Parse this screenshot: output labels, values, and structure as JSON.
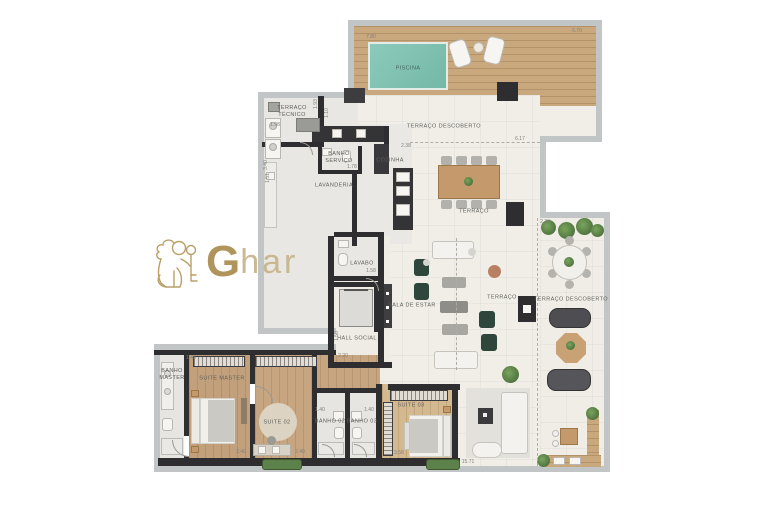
{
  "brand": {
    "initial": "G",
    "rest": "har"
  },
  "colors": {
    "gold": "#b1945a",
    "pool_water": "#84c6b4",
    "deck_wood": "#c9a87e",
    "wall": "#2e2e30",
    "floor": "#f1eee8",
    "green_armchair": "#2f463c"
  },
  "labels": {
    "piscina": "PISCINA",
    "terraco_descoberto_top": "TERRAÇO DESCOBERTO",
    "terraco_tecnico": "TERRAÇO\nTÉCNICO",
    "banho_servico": "BANHO\nSERVIÇO",
    "lavanderia": "LAVANDERIA",
    "cozinha": "COZINHA",
    "terraco": "TERRAÇO",
    "lavabo": "LAVABO",
    "hall_social": "HALL SOCIAL",
    "sala_de_estar": "SALA DE ESTAR",
    "terraco_small": "TERRAÇO",
    "terraco_descoberto_right": "TERRAÇO DESCOBERTO",
    "banho_master": "BANHO\nMASTER",
    "suite_master": "SUITE MASTER",
    "suite_02": "SUITE 02",
    "banho_02": "BANHO 02",
    "banho_03": "BANHO 03",
    "suite_03": "SUITE 03"
  },
  "dimensions": {
    "pool_width": "7.80",
    "deck_right": "5.70",
    "tecnico_width": "1.98",
    "tecnico_height": "1.10",
    "servico_side": "1.93",
    "servico_width": "1.78",
    "lavanderia_height": "3.40",
    "lavanderia_height2": "1.51",
    "cozinha_top": "2.38",
    "terraco_width": "6.17",
    "lavabo_width": "1.58",
    "hall_height": "1.50",
    "hall_width": "2.20",
    "terraco_right_top": "2.38",
    "banho_master_width": "1.45",
    "suite_master_width": "2.40",
    "suite_02_width": "2.40",
    "banho_02_width": "1.40",
    "banho_03_width": "1.40",
    "suite_03_width": "3.58",
    "total_width": "15.71"
  }
}
